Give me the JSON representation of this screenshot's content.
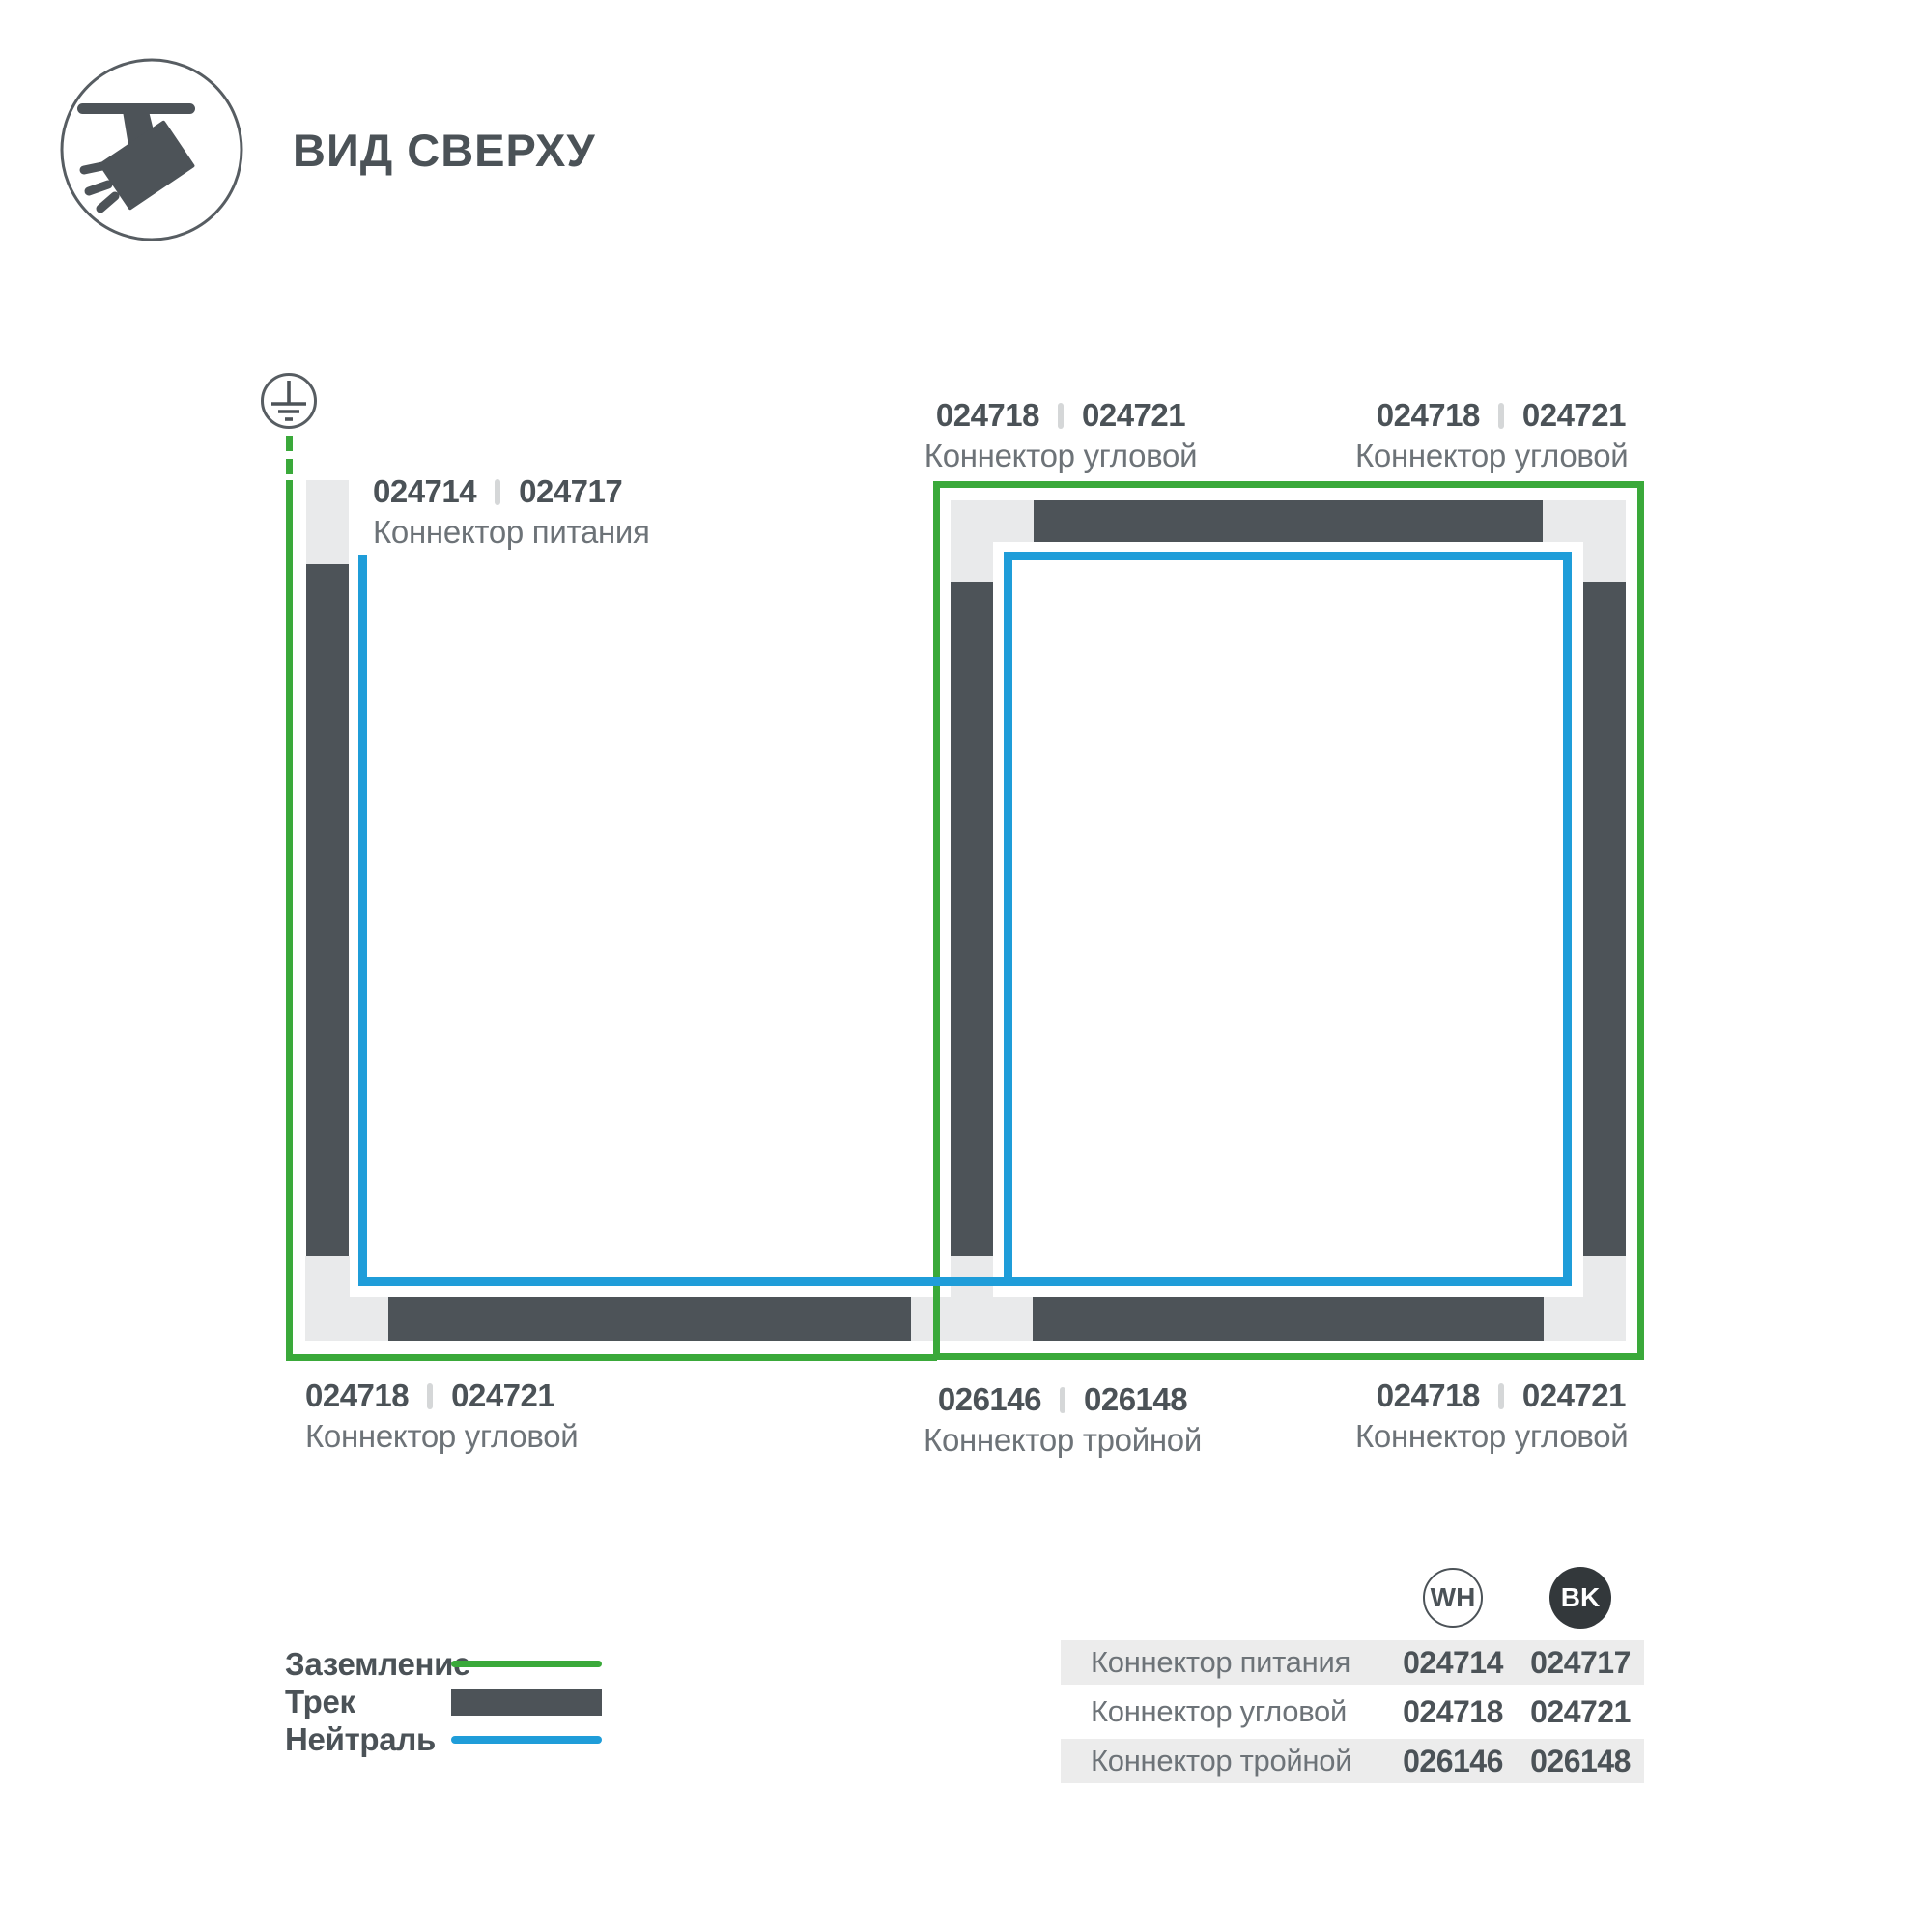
{
  "header": {
    "title": "ВИД СВЕРХУ",
    "icon": "track-spotlight-icon"
  },
  "colors": {
    "green": "#3aa93a",
    "blue": "#1f9dd9",
    "track": "#4d5358",
    "connector": "#e9eaeb",
    "text-dark": "#4b5257",
    "text-muted": "#6d7378",
    "separator": "#d5d7d8",
    "row-bg": "#ececec",
    "bk-badge": "#33383b"
  },
  "diagram": {
    "ground_icon": "earth-ground-symbol",
    "labels": {
      "power": {
        "code_wh": "024714",
        "code_bk": "024717",
        "name": "Коннектор питания"
      },
      "corner_top_mid": {
        "code_wh": "024718",
        "code_bk": "024721",
        "name": "Коннектор угловой"
      },
      "corner_top_right": {
        "code_wh": "024718",
        "code_bk": "024721",
        "name": "Коннектор угловой"
      },
      "corner_bottom_left": {
        "code_wh": "024718",
        "code_bk": "024721",
        "name": "Коннектор угловой"
      },
      "triple_bottom_mid": {
        "code_wh": "026146",
        "code_bk": "026148",
        "name": "Коннектор тройной"
      },
      "corner_bottom_right": {
        "code_wh": "024718",
        "code_bk": "024721",
        "name": "Коннектор угловой"
      }
    }
  },
  "legend": {
    "items": [
      {
        "label": "Заземление",
        "swatch": "ground-line"
      },
      {
        "label": "Трек",
        "swatch": "track-bar"
      },
      {
        "label": "Нейтраль",
        "swatch": "neutral-line"
      }
    ]
  },
  "table": {
    "columns": {
      "wh": "WH",
      "bk": "BK"
    },
    "rows": [
      {
        "name": "Коннектор питания",
        "wh": "024714",
        "bk": "024717"
      },
      {
        "name": "Коннектор угловой",
        "wh": "024718",
        "bk": "024721"
      },
      {
        "name": "Коннектор тройной",
        "wh": "026146",
        "bk": "026148"
      }
    ]
  }
}
